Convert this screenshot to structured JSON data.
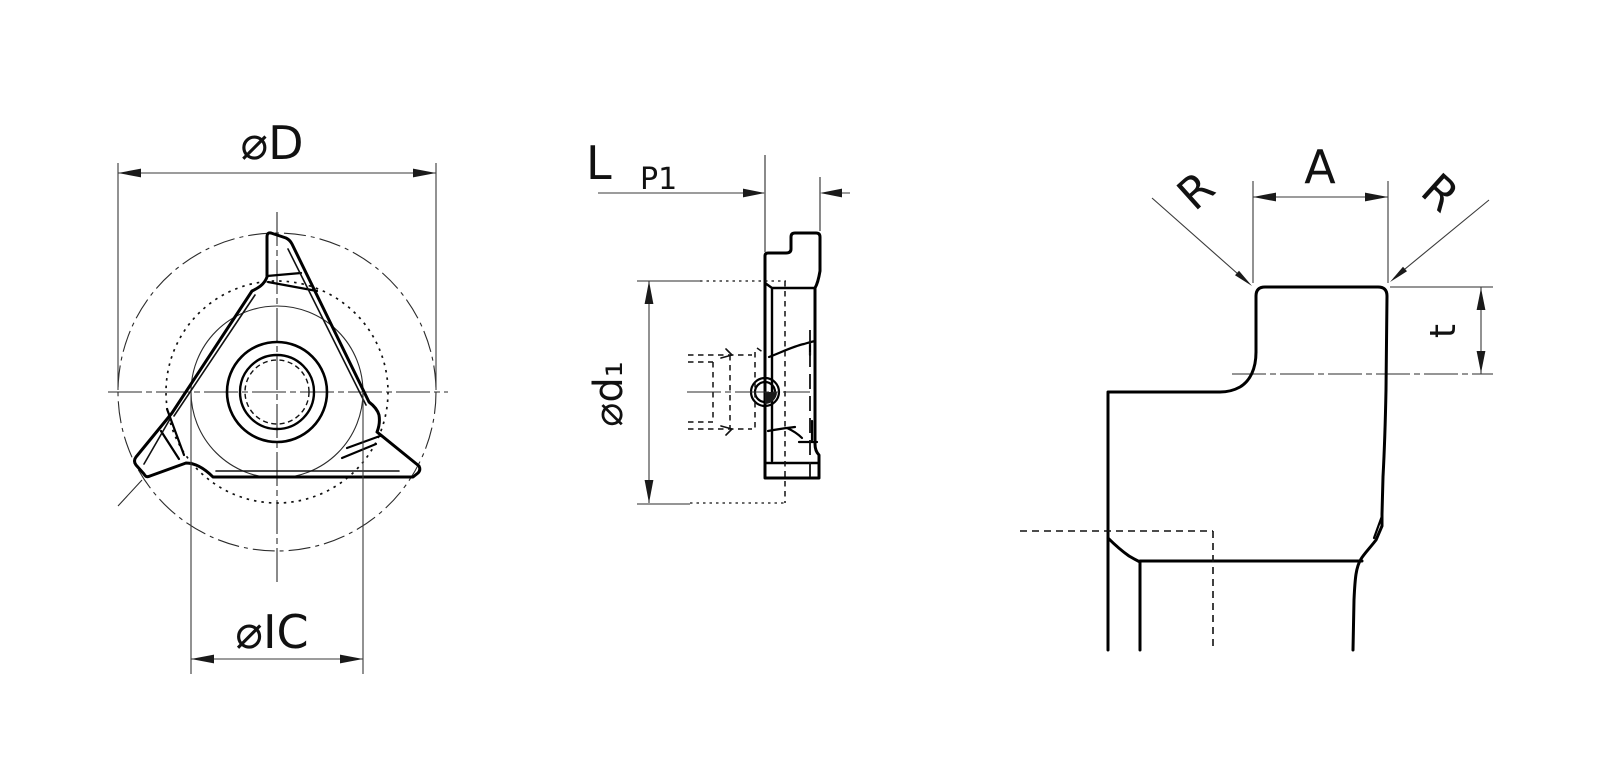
{
  "front_view": {
    "dim_outer": "⌀D",
    "dim_inscribed": "⌀IC"
  },
  "side_view": {
    "dim_length": "L",
    "dim_p1": "P1",
    "dim_d1": "⌀d₁"
  },
  "profile_view": {
    "dim_radius_left": "R",
    "dim_width": "A",
    "dim_radius_right": "R",
    "dim_depth": "t"
  },
  "colors": {
    "line": "#000000",
    "thin_line": "#2b2b2b",
    "background": "#ffffff"
  }
}
